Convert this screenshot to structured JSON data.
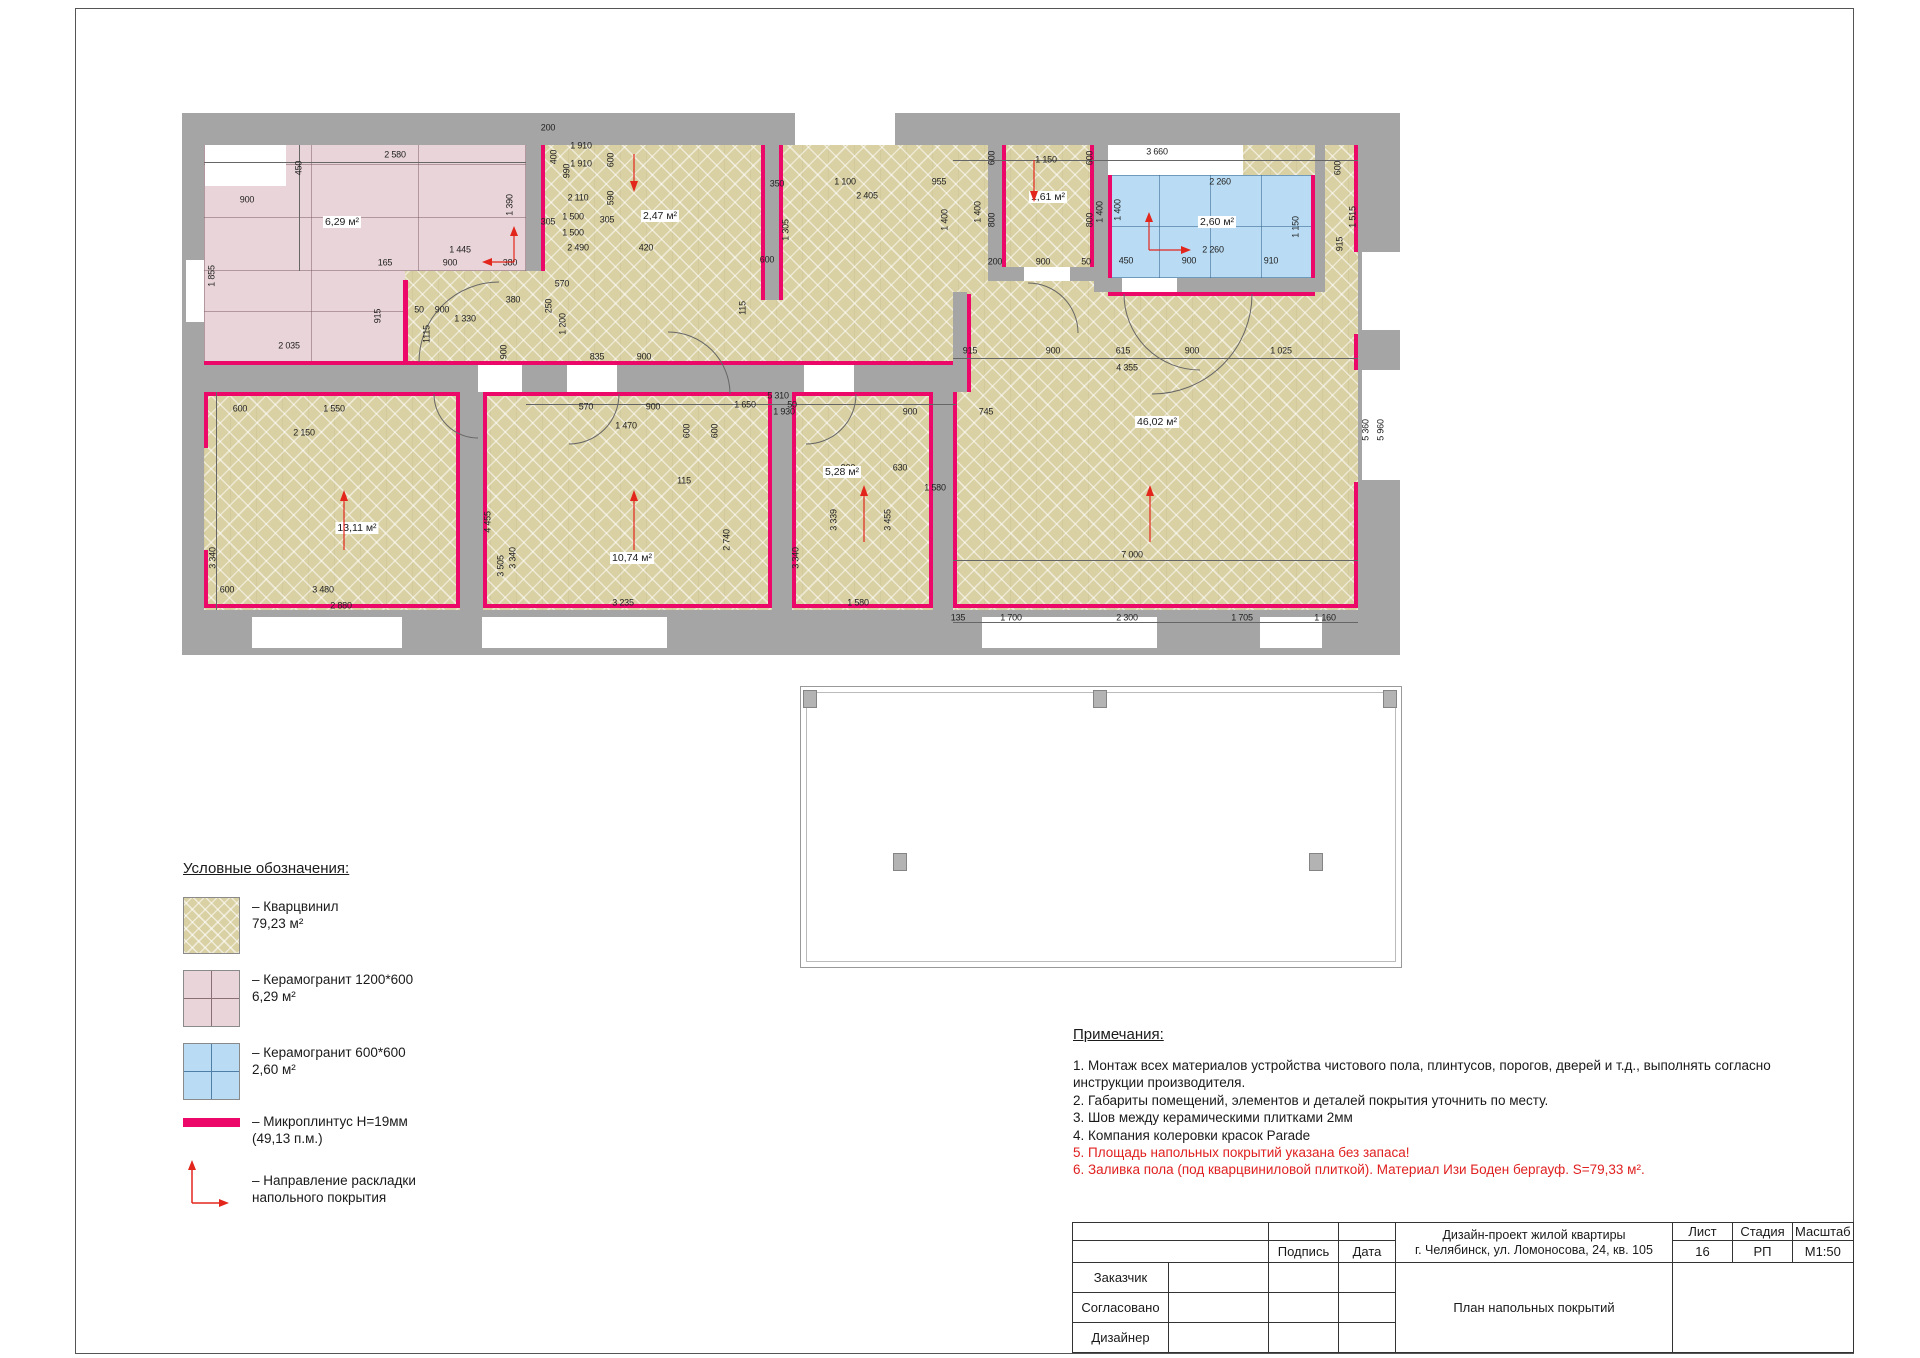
{
  "colors": {
    "wall": "#a5a5a5",
    "quartz": "#d9d0a3",
    "ceramic1200": "#e9d4d9",
    "ceramic600": "#b9dcf4",
    "microplinth": "#ec0868",
    "arrow": "#e3261c",
    "note_red": "#e02020"
  },
  "legend": {
    "heading": "Условные обозначения:",
    "items": [
      {
        "label": "– Кварцвинил",
        "value": "79,23 м²"
      },
      {
        "label": "– Керамогранит 1200*600",
        "value": "6,29 м²"
      },
      {
        "label": "– Керамогранит 600*600",
        "value": "2,60 м²"
      },
      {
        "label": "– Микроплинтус Н=19мм",
        "value": "(49,13 п.м.)"
      },
      {
        "label": "– Направление раскладки",
        "value": "напольного покрытия"
      }
    ]
  },
  "notes": {
    "heading": "Примечания:",
    "lines": [
      {
        "text": "1.  Монтаж всех материалов устройства чистового пола, плинтусов, порогов, дверей и т.д., выполнять согласно",
        "red": false
      },
      {
        "text": "инструкции производителя.",
        "red": false
      },
      {
        "text": "2. Габариты помещений, элементов и деталей покрытия уточнить по месту.",
        "red": false
      },
      {
        "text": "3. Шов между керамическими плитками 2мм",
        "red": false
      },
      {
        "text": "4. Компания колеровки красок Parade",
        "red": false
      },
      {
        "text": "5. Площадь напольных покрытий указана без запаса!",
        "red": true
      },
      {
        "text": "6. Заливка пола (под кварцвиниловой плиткой). Материал Изи Боден бергауф. S=79,33 м².",
        "red": true
      }
    ]
  },
  "plan": {
    "area_labels": [
      {
        "t": "6,29 м²",
        "x": 160,
        "y": 122
      },
      {
        "t": "2,47 м²",
        "x": 478,
        "y": 116
      },
      {
        "t": "1,61 м²",
        "x": 866,
        "y": 97
      },
      {
        "t": "2,60 м²",
        "x": 1035,
        "y": 122
      },
      {
        "t": "13,11 м²",
        "x": 175,
        "y": 428
      },
      {
        "t": "10,74 м²",
        "x": 450,
        "y": 458
      },
      {
        "t": "5,28 м²",
        "x": 660,
        "y": 372
      },
      {
        "t": "46,02 м²",
        "x": 975,
        "y": 322
      }
    ],
    "dimensions": [
      [
        "2 580",
        213,
        55,
        0
      ],
      [
        "450",
        117,
        68,
        1
      ],
      [
        "900",
        65,
        100,
        0
      ],
      [
        "1 390",
        328,
        105,
        1
      ],
      [
        "1 855",
        30,
        176,
        1
      ],
      [
        "1 445",
        278,
        150,
        0
      ],
      [
        "165",
        203,
        163,
        0
      ],
      [
        "900",
        268,
        163,
        0
      ],
      [
        "380",
        328,
        163,
        0
      ],
      [
        "915",
        196,
        216,
        1
      ],
      [
        "2 035",
        107,
        246,
        0
      ],
      [
        "50",
        237,
        210,
        0
      ],
      [
        "900",
        260,
        210,
        0
      ],
      [
        "1 330",
        283,
        219,
        0
      ],
      [
        "1115",
        245,
        234,
        1
      ],
      [
        "380",
        331,
        200,
        0
      ],
      [
        "900",
        322,
        252,
        1
      ],
      [
        "250",
        367,
        206,
        1
      ],
      [
        "1 200",
        381,
        224,
        1
      ],
      [
        "570",
        380,
        184,
        0
      ],
      [
        "835",
        415,
        257,
        0
      ],
      [
        "900",
        462,
        257,
        0
      ],
      [
        "200",
        366,
        28,
        0
      ],
      [
        "1 910",
        399,
        46,
        0
      ],
      [
        "1 910",
        399,
        64,
        0
      ],
      [
        "400",
        372,
        57,
        1
      ],
      [
        "990",
        385,
        71,
        1
      ],
      [
        "600",
        429,
        60,
        1
      ],
      [
        "2 110",
        396,
        98,
        0
      ],
      [
        "590",
        429,
        98,
        1
      ],
      [
        "1 500",
        391,
        117,
        0
      ],
      [
        "305",
        425,
        120,
        0
      ],
      [
        "1 500",
        391,
        133,
        0
      ],
      [
        "2 490",
        396,
        148,
        0
      ],
      [
        "420",
        464,
        148,
        0
      ],
      [
        "305",
        366,
        122,
        0
      ],
      [
        "1 305",
        604,
        130,
        1
      ],
      [
        "350",
        595,
        84,
        0
      ],
      [
        "1 100",
        663,
        82,
        0
      ],
      [
        "955",
        757,
        82,
        0
      ],
      [
        "2 405",
        685,
        96,
        0
      ],
      [
        "1 400",
        763,
        120,
        1
      ],
      [
        "600",
        585,
        160,
        0
      ],
      [
        "115",
        561,
        208,
        1
      ],
      [
        "5 310",
        596,
        296,
        0
      ],
      [
        "1 930",
        602,
        312,
        0
      ],
      [
        "900",
        728,
        312,
        0
      ],
      [
        "745",
        804,
        312,
        0
      ],
      [
        "1 150",
        864,
        60,
        0
      ],
      [
        "600",
        810,
        58,
        1
      ],
      [
        "600",
        908,
        58,
        1
      ],
      [
        "800",
        810,
        120,
        1
      ],
      [
        "800",
        908,
        120,
        1
      ],
      [
        "1 400",
        796,
        112,
        1
      ],
      [
        "1 400",
        918,
        112,
        1
      ],
      [
        "200",
        813,
        162,
        0
      ],
      [
        "900",
        861,
        162,
        0
      ],
      [
        "50",
        904,
        162,
        0
      ],
      [
        "1 400",
        936,
        110,
        1
      ],
      [
        "2 260",
        1038,
        82,
        0
      ],
      [
        "2 260",
        1031,
        150,
        0
      ],
      [
        "450",
        944,
        161,
        0
      ],
      [
        "900",
        1007,
        161,
        0
      ],
      [
        "910",
        1089,
        161,
        0
      ],
      [
        "1 150",
        1114,
        127,
        1
      ],
      [
        "600",
        1156,
        68,
        1
      ],
      [
        "1 515",
        1171,
        117,
        1
      ],
      [
        "915",
        1158,
        144,
        1
      ],
      [
        "915",
        788,
        251,
        0
      ],
      [
        "900",
        871,
        251,
        0
      ],
      [
        "615",
        941,
        251,
        0
      ],
      [
        "900",
        1010,
        251,
        0
      ],
      [
        "1 025",
        1099,
        251,
        0
      ],
      [
        "4 355",
        945,
        268,
        0
      ],
      [
        "600",
        58,
        309,
        0
      ],
      [
        "1 550",
        152,
        309,
        0
      ],
      [
        "2 150",
        122,
        333,
        0
      ],
      [
        "570",
        404,
        307,
        0
      ],
      [
        "900",
        471,
        307,
        0
      ],
      [
        "1 470",
        444,
        326,
        0
      ],
      [
        "600",
        505,
        331,
        1
      ],
      [
        "600",
        533,
        331,
        1
      ],
      [
        "115",
        502,
        381,
        0
      ],
      [
        "1 650",
        563,
        305,
        0
      ],
      [
        "50",
        610,
        305,
        0
      ],
      [
        "900",
        666,
        368,
        0
      ],
      [
        "630",
        718,
        368,
        0
      ],
      [
        "1 580",
        753,
        388,
        0
      ],
      [
        "4 455",
        306,
        422,
        1
      ],
      [
        "3 505",
        319,
        466,
        1
      ],
      [
        "3 340",
        31,
        458,
        1
      ],
      [
        "3 340",
        331,
        458,
        1
      ],
      [
        "3 340",
        614,
        458,
        1
      ],
      [
        "2 740",
        545,
        440,
        1
      ],
      [
        "3 339",
        652,
        420,
        1
      ],
      [
        "3 455",
        706,
        420,
        1
      ],
      [
        "3 660",
        975,
        52,
        0
      ],
      [
        "5 960",
        1199,
        330,
        1
      ],
      [
        "5 360",
        1184,
        330,
        1
      ],
      [
        "7 000",
        950,
        455,
        0
      ],
      [
        "135",
        776,
        518,
        0
      ],
      [
        "1 700",
        829,
        518,
        0
      ],
      [
        "2 300",
        945,
        518,
        0
      ],
      [
        "1 705",
        1060,
        518,
        0
      ],
      [
        "1 160",
        1143,
        518,
        0
      ],
      [
        "3 480",
        141,
        490,
        0
      ],
      [
        "2 880",
        159,
        506,
        0
      ],
      [
        "600",
        45,
        490,
        0
      ],
      [
        "3 235",
        441,
        503,
        0
      ],
      [
        "1 580",
        676,
        503,
        0
      ]
    ],
    "arrows": [
      {
        "dir": "up",
        "x": 162,
        "y": 390,
        "len": 58
      },
      {
        "dir": "up",
        "x": 452,
        "y": 390,
        "len": 58
      },
      {
        "dir": "up",
        "x": 682,
        "y": 385,
        "len": 55
      },
      {
        "dir": "up",
        "x": 968,
        "y": 385,
        "len": 55
      },
      {
        "dir": "down",
        "x": 852,
        "y": 58,
        "len": 40
      },
      {
        "dir": "down",
        "x": 452,
        "y": 52,
        "len": 36
      },
      {
        "dir": "L-up-left",
        "x": 300,
        "y": 126,
        "w": 28,
        "h": 32
      },
      {
        "dir": "L-up-right",
        "x": 963,
        "y": 112,
        "w": 38,
        "h": 34
      }
    ]
  },
  "title_block": {
    "podpis": "Подпись",
    "data": "Дата",
    "zakazchik": "Заказчик",
    "soglasovano": "Согласовано",
    "dizayner": "Дизайнер",
    "project_line1": "Дизайн-проект жилой квартиры",
    "project_line2": "г. Челябинск, ул. Ломоносова, 24, кв. 105",
    "list_label": "Лист",
    "list_value": "16",
    "stage_label": "Стадия",
    "stage_value": "РП",
    "scale_label": "Масштаб",
    "scale_value": "М1:50",
    "title": "План напольных покрытий"
  }
}
